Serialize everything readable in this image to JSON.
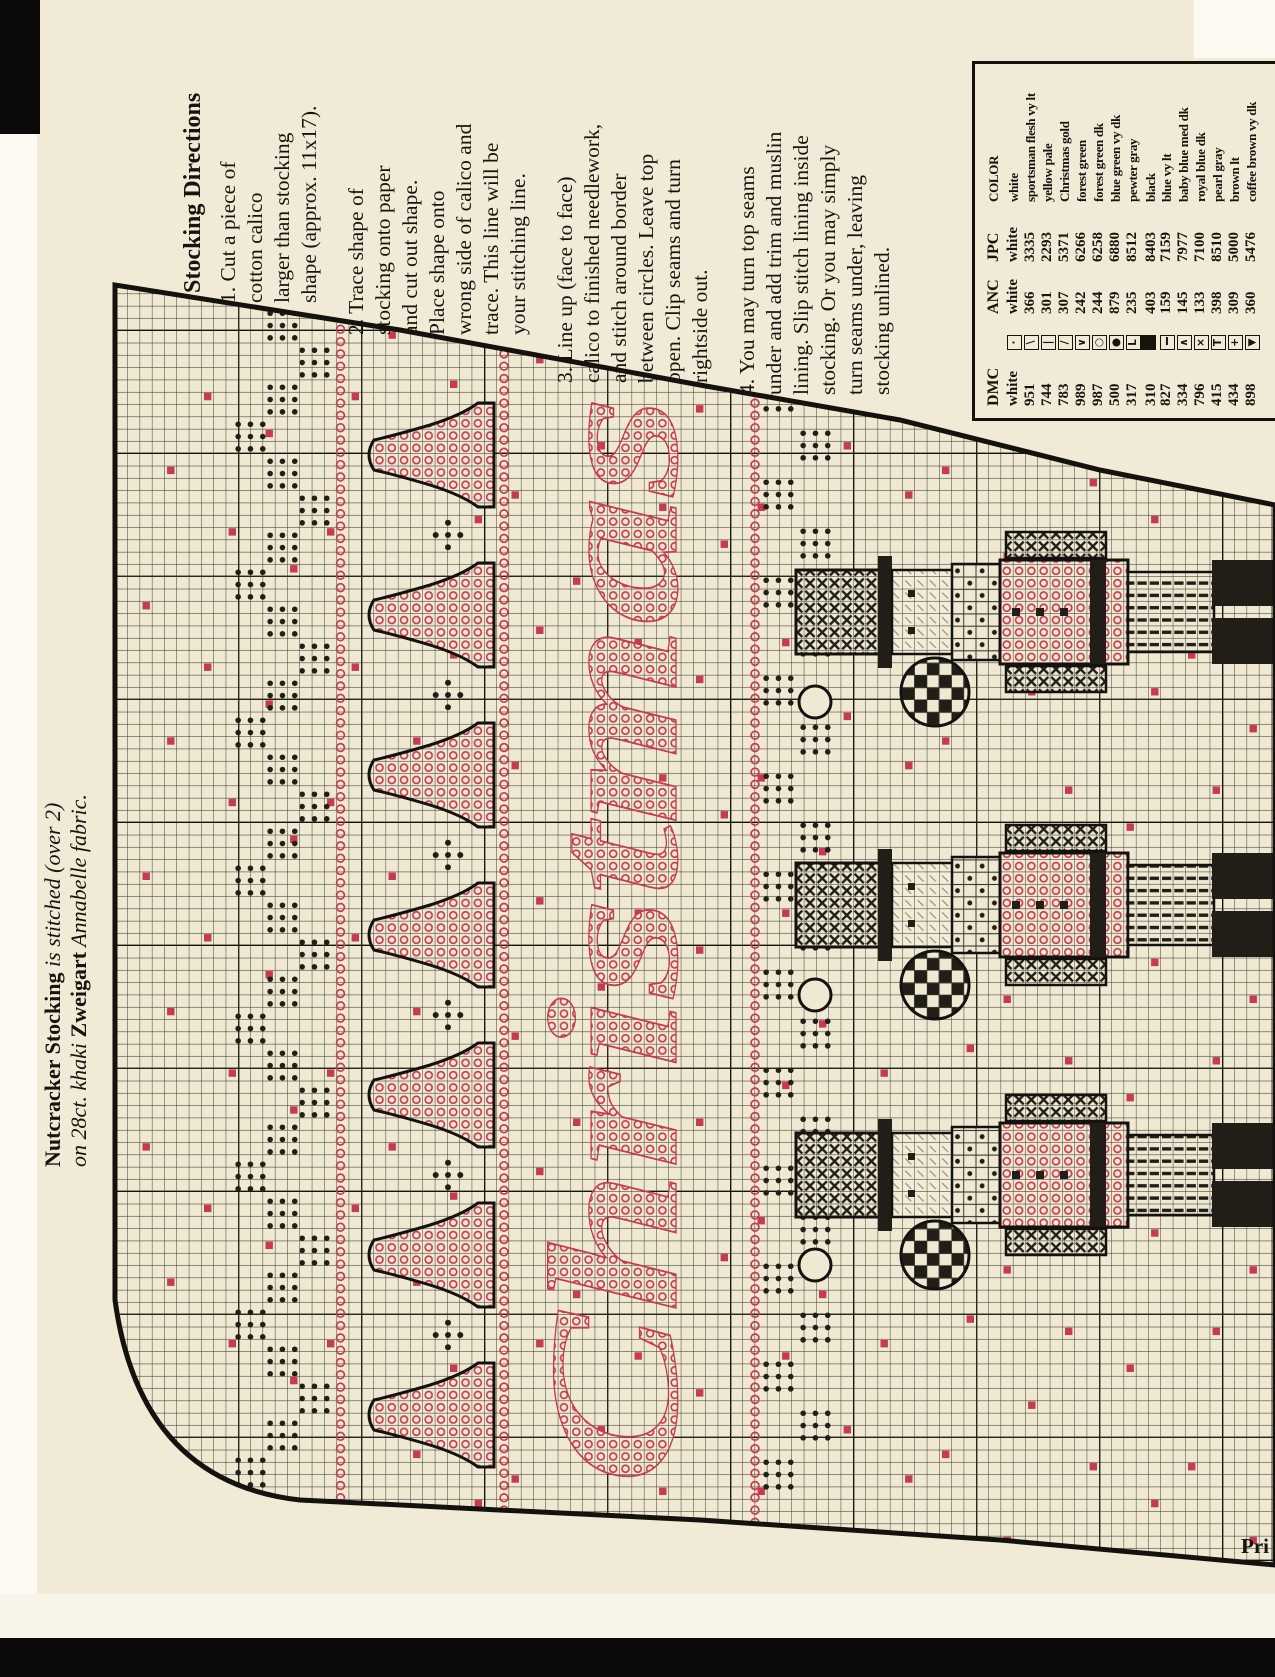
{
  "page": {
    "caption": {
      "line1_bold": "Nutcracker Stocking",
      "line1_italic": " is stitched (over 2)",
      "line2_pre": "on 28ct. khaki ",
      "line2_bold": "Zweigart",
      "line2_post": " Annabelle fabric."
    },
    "footer_cut_text": "Pri",
    "directions": {
      "title": "Stocking Directions",
      "steps": [
        "1. Cut a piece of\ncotton calico\nlarger than stocking\nshape (approx. 11x17).",
        "2. Trace shape of\nstocking onto paper\nand cut out shape.\nPlace shape onto\nwrong side of calico and\ntrace. This line will be\nyour stitching line.",
        "3. Line up (face to face)\ncalico to finished needlework,\nand stitch around border\nbetween circles. Leave top\nopen. Clip seams and turn\nrightside out.",
        "4. You may turn top seams\nunder and add trim and muslin\nlining. Slip stitch lining inside\nstocking. Or you may simply\nturn seams under, leaving\nstocking unlined."
      ]
    },
    "key": {
      "headers": {
        "dmc": "DMC",
        "anc": "ANC",
        "jpc": "JPC",
        "color": "COLOR"
      },
      "rows": [
        {
          "dmc": "white",
          "symbol": "dot",
          "anc": "white",
          "jpc": "white",
          "color": "white"
        },
        {
          "dmc": "951",
          "symbol": "backslash",
          "anc": "366",
          "jpc": "3335",
          "color": "sportsman flesh vy lt"
        },
        {
          "dmc": "744",
          "symbol": "vbar",
          "anc": "301",
          "jpc": "2293",
          "color": "yellow pale"
        },
        {
          "dmc": "783",
          "symbol": "slash",
          "anc": "307",
          "jpc": "5371",
          "color": "Christmas gold"
        },
        {
          "dmc": "989",
          "symbol": "chevron-down",
          "anc": "242",
          "jpc": "6266",
          "color": "forest green"
        },
        {
          "dmc": "987",
          "symbol": "circle",
          "anc": "244",
          "jpc": "6258",
          "color": "forest green dk"
        },
        {
          "dmc": "500",
          "symbol": "filled-circle",
          "anc": "879",
          "jpc": "6880",
          "color": "blue green vy dk"
        },
        {
          "dmc": "317",
          "symbol": "corner-L",
          "anc": "235",
          "jpc": "8512",
          "color": "pewter gray"
        },
        {
          "dmc": "310",
          "symbol": "filled-square",
          "anc": "403",
          "jpc": "8403",
          "color": "black"
        },
        {
          "dmc": "827",
          "symbol": "ibeam",
          "anc": "159",
          "jpc": "7159",
          "color": "blue vy lt"
        },
        {
          "dmc": "334",
          "symbol": "chevron-up",
          "anc": "145",
          "jpc": "7977",
          "color": "baby blue med dk"
        },
        {
          "dmc": "796",
          "symbol": "x-mark",
          "anc": "133",
          "jpc": "7100",
          "color": "royal blue dk"
        },
        {
          "dmc": "415",
          "symbol": "tee",
          "anc": "398",
          "jpc": "8510",
          "color": "pearl gray"
        },
        {
          "dmc": "434",
          "symbol": "plus",
          "anc": "309",
          "jpc": "5000",
          "color": "brown lt"
        },
        {
          "dmc": "898",
          "symbol": "triangle-down",
          "anc": "360",
          "jpc": "5476",
          "color": "coffee brown vy dk"
        }
      ]
    },
    "chart": {
      "lettering": "Christmas",
      "motifs": [
        "dot-diamond zigzag border",
        "red circle line",
        "bell border",
        "nutcracker figures"
      ]
    },
    "colors": {
      "paper": "#f0ead6",
      "ink": "#17140f",
      "red": "#c63a52"
    }
  }
}
